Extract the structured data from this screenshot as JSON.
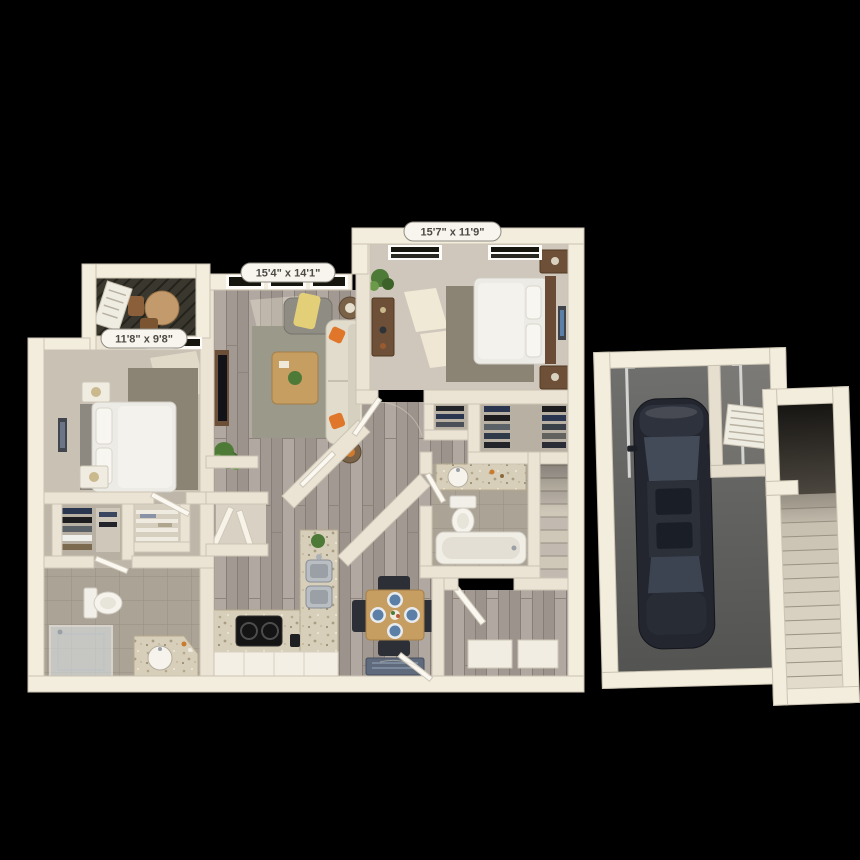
{
  "scene": {
    "description": "3D top-down architectural floor plan render of a two-bedroom apartment with attached one-car garage and exterior stairwell on a black background",
    "background_color": "#000000"
  },
  "dimension_labels": [
    {
      "room": "bedroom-2",
      "text": "15'7\" x 11'9\""
    },
    {
      "room": "living-room",
      "text": "15'4\" x 14'1\""
    },
    {
      "room": "bedroom-1",
      "text": "11'8\" x 9'8\""
    }
  ],
  "label_style": {
    "background": "#f7f5ee",
    "border": "#8f8c83",
    "text_color": "#4c4a44"
  },
  "palette": {
    "walls_outer": "#f3edde",
    "walls_inner": "#ebe4d5",
    "wood_floor": "#a9a199",
    "carpet": "#c9c1b4",
    "tile": "#aca397",
    "rug_olive": "#8b8474",
    "rug_sage": "#9b9a8a",
    "granite_counter": "#d8cfba",
    "garage_floor": "#6f6f6d",
    "car_body": "#23262e",
    "stair_carpet": "#d3cbbc",
    "patio_floor": "#3a382e",
    "accent_orange": "#e0762a",
    "plant_green": "#4e7a38",
    "plate_blue": "#5b7fa6",
    "cabinet_white": "#f4efe4"
  },
  "objects": [
    "patio-table",
    "bed",
    "nightstand",
    "lamp",
    "artwork",
    "rug",
    "window",
    "tv",
    "sofa",
    "accent-chair",
    "coffee-table",
    "side-table",
    "plant",
    "kitchen-island",
    "kitchen-sink",
    "cooktop",
    "cabinets",
    "dining-table",
    "dining-chair",
    "plate",
    "door-mat",
    "toilet",
    "bathtub",
    "shower",
    "vanity-sink",
    "clothes-rack",
    "linen-shelves",
    "stairs",
    "car",
    "garage-door-track",
    "vent-window",
    "door-leaf"
  ]
}
